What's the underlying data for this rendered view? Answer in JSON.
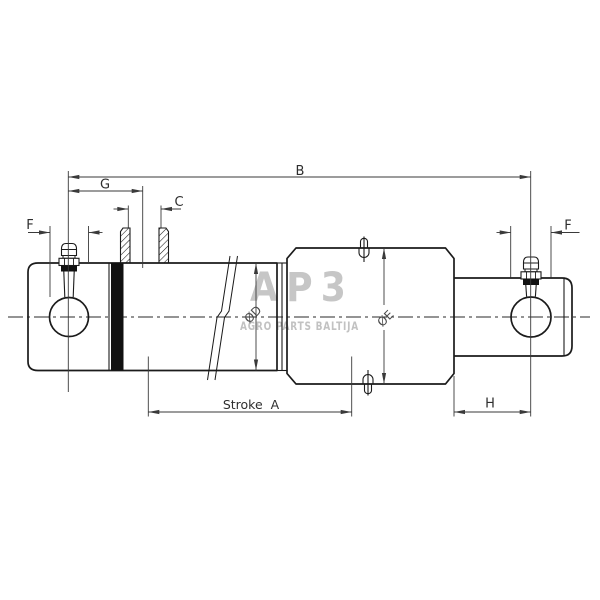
{
  "drawing": {
    "type": "hydraulic-cylinder-dimension-drawing",
    "watermark": {
      "logo": "AP3",
      "subtitle": "AGRO PARTS BALTIJA"
    },
    "labels": {
      "overall_length": "B",
      "port_position": "G",
      "port_thread": "C",
      "pin_bore_left": "F",
      "pin_bore_right": "F",
      "stroke": "Stroke  A",
      "rod_end_length": "H",
      "barrel_diameter": "ØD",
      "guide_diameter": "ØE"
    },
    "colors": {
      "background": "#ffffff",
      "outline": "#1b1b1b",
      "dimension": "#3a3a3a",
      "seal_band": "#111111",
      "watermark": "#c6c6c6"
    }
  }
}
